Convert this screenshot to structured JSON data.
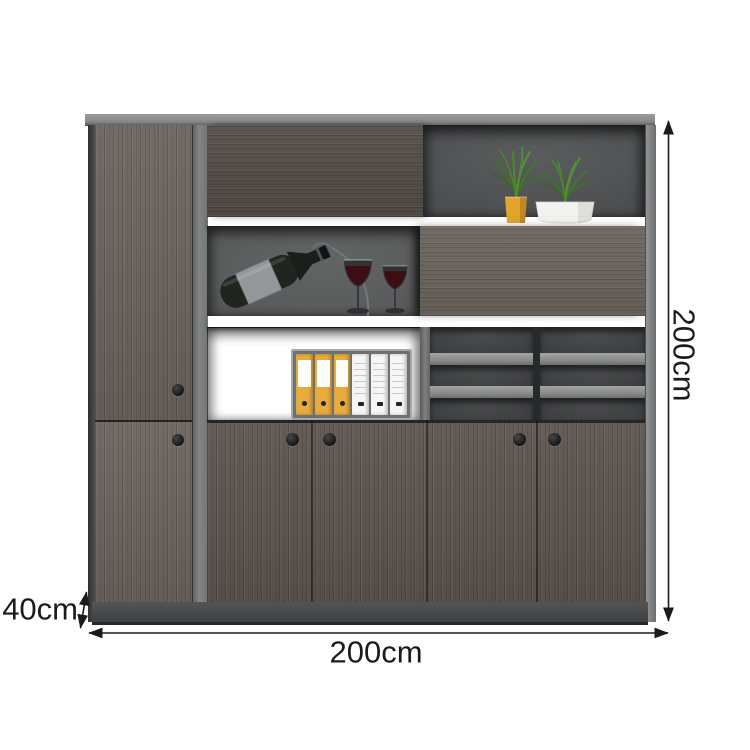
{
  "annotations": {
    "height_label": "200cm",
    "width_label": "200cm",
    "depth_label": "40cm"
  },
  "theme": {
    "line": "#1b1b1b",
    "frame_light": "#8f9192",
    "wood_dark": "#534d46",
    "wood_mid": "#5f5851",
    "wood_light": "#6b645d",
    "wood_door": "#5c554e",
    "back_mid": "#4b4d4f",
    "back_light": "#565859",
    "back_dark": "#3b3d3f",
    "plinth": "#46484a",
    "handle": "#202224",
    "binder_yellow": "#e7ab3e",
    "pot_yellow": "#e2a42c",
    "pot_white": "#f2f2ef",
    "plant_green": "#4a8032",
    "wine_red": "#3c0e14"
  },
  "contents": {
    "plants": 2,
    "wine_bottles": 1,
    "wine_glasses": 2,
    "yellow_binders": 3,
    "white_binders": 3,
    "pigeonhole_columns": 2,
    "pigeonhole_rows": 3,
    "visible_door_handles": 6
  }
}
